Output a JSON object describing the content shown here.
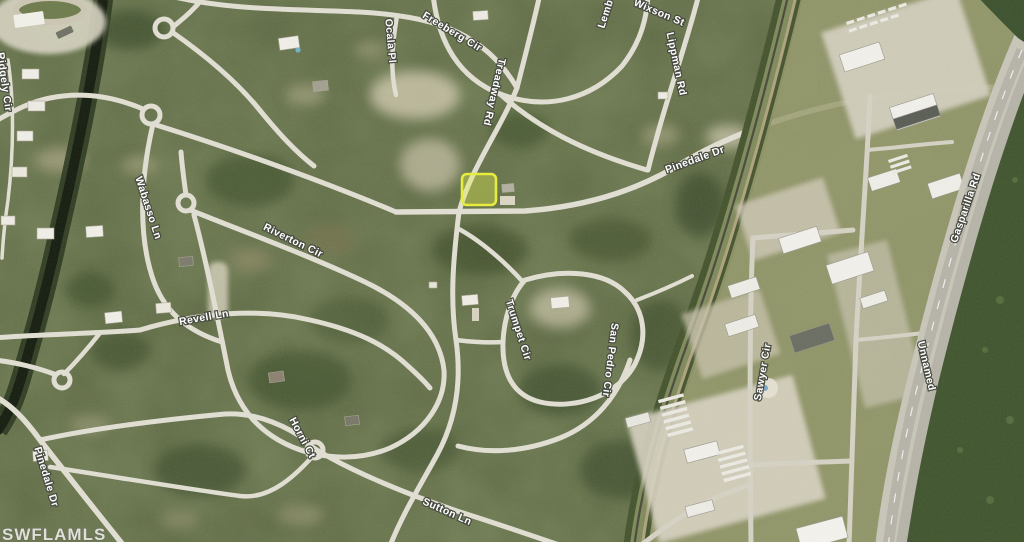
{
  "watermark": "SWFLAMLS",
  "parcel_highlight": {
    "color": "#e8ee3a"
  },
  "map_colors": {
    "terrain_green": "#5f6b45",
    "road": "#e2dfd3",
    "canal_water": "#1d2517",
    "highway": "#b9b6ab",
    "label_text": "#ffffff"
  },
  "street_labels": [
    {
      "text": "Freeberg Cir",
      "x": 452,
      "y": 32,
      "rotate": 31
    },
    {
      "text": "Ocala Pl",
      "x": 390,
      "y": 41,
      "rotate": 85
    },
    {
      "text": "Ridgely Cir",
      "x": 4,
      "y": 82,
      "rotate": 82
    },
    {
      "text": "Lemb",
      "x": 606,
      "y": 14,
      "rotate": -72
    },
    {
      "text": "Wixson St",
      "x": 659,
      "y": 13,
      "rotate": 23
    },
    {
      "text": "Lippman Rd",
      "x": 676,
      "y": 64,
      "rotate": 78
    },
    {
      "text": "Treadway Rd",
      "x": 494,
      "y": 92,
      "rotate": 103
    },
    {
      "text": "Pinedale Dr",
      "x": 695,
      "y": 160,
      "rotate": -20
    },
    {
      "text": "Riverton Cir",
      "x": 293,
      "y": 241,
      "rotate": 26
    },
    {
      "text": "Wabasso Ln",
      "x": 148,
      "y": 208,
      "rotate": 72
    },
    {
      "text": "Revell Ln",
      "x": 204,
      "y": 318,
      "rotate": -10
    },
    {
      "text": "Horni Ct",
      "x": 302,
      "y": 438,
      "rotate": 62
    },
    {
      "text": "Trumpet Cir",
      "x": 518,
      "y": 330,
      "rotate": 72
    },
    {
      "text": "San Pedro Cir",
      "x": 610,
      "y": 360,
      "rotate": 97
    },
    {
      "text": "Sutton Ln",
      "x": 447,
      "y": 512,
      "rotate": 24
    },
    {
      "text": "Pinedale Dr",
      "x": 46,
      "y": 477,
      "rotate": 73
    },
    {
      "text": "Sawyer Cir",
      "x": 763,
      "y": 372,
      "rotate": -80
    },
    {
      "text": "Unnamed",
      "x": 926,
      "y": 366,
      "rotate": 77
    },
    {
      "text": "Gasparilla Rd",
      "x": 966,
      "y": 208,
      "rotate": -71
    }
  ]
}
